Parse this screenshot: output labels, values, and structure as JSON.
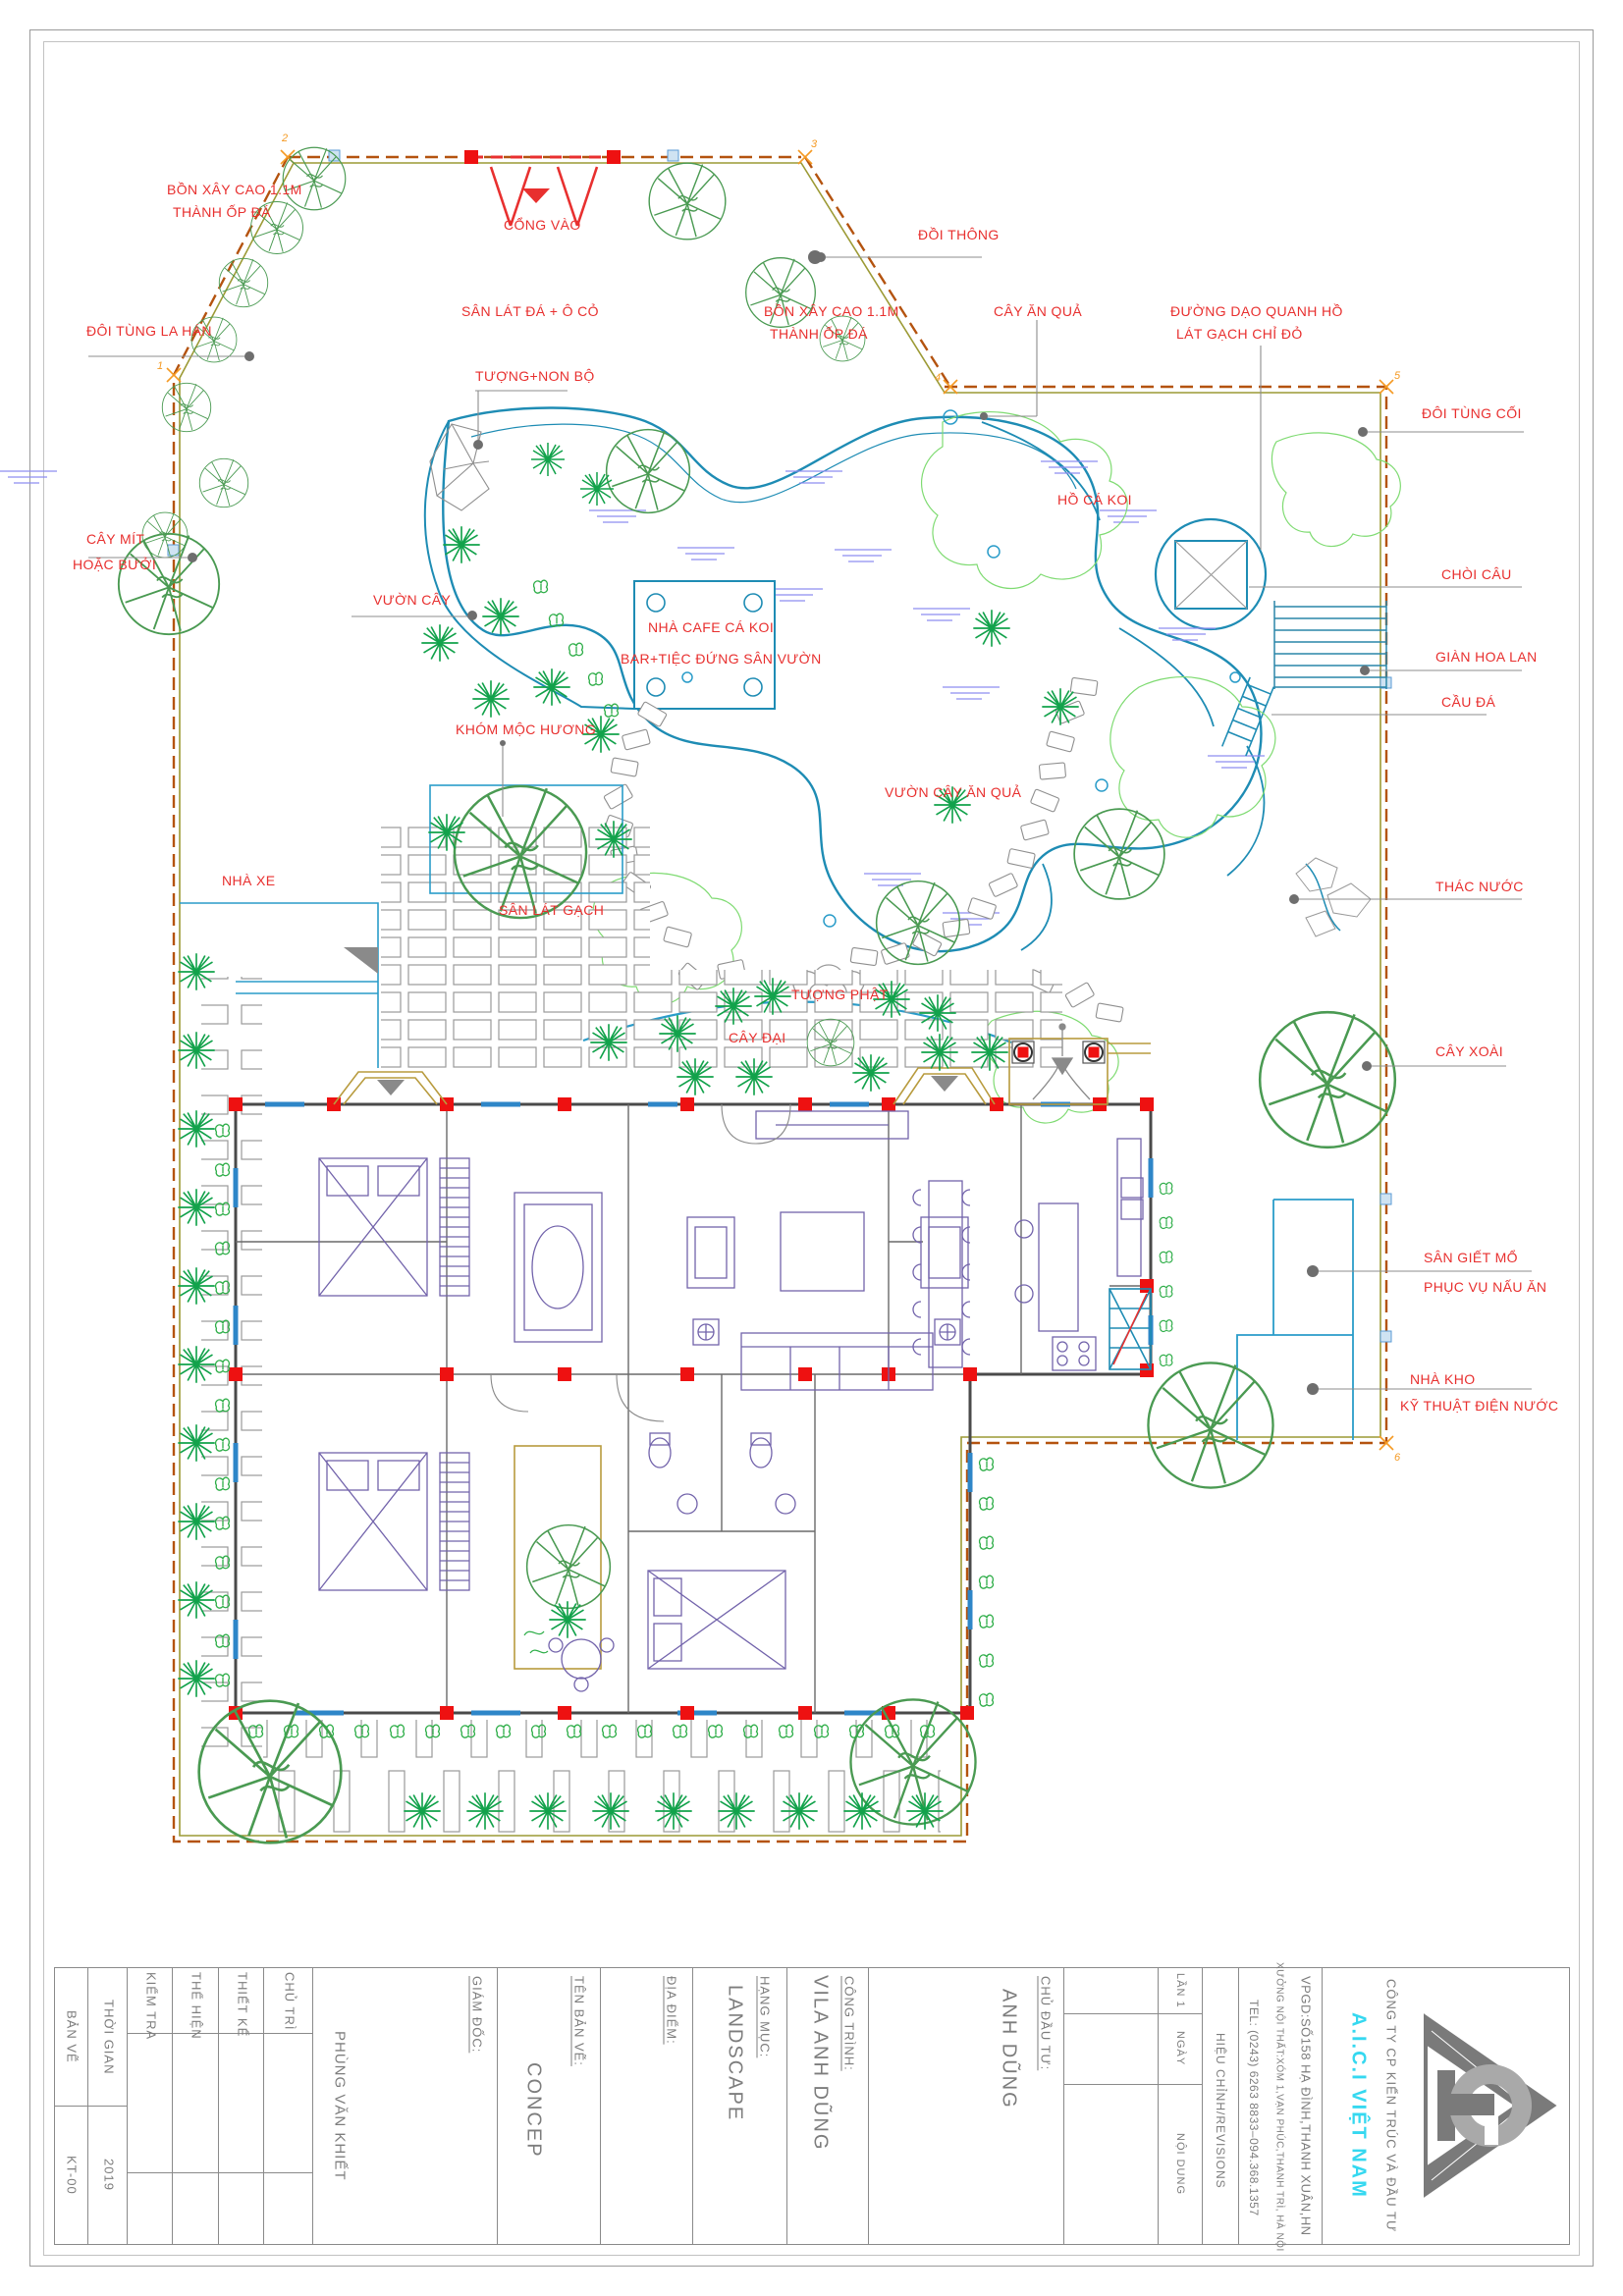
{
  "plan": {
    "labels": {
      "bon_xay_1a": "BỒN XÂY CAO 1.1M",
      "bon_xay_1b": "THÀNH ỐP ĐÁ",
      "cong_vao": "CỔNG VÀO",
      "doi_thong": "ĐỒI THÔNG",
      "doi_tung_la_han": "ĐÔI TÙNG LA HÁN",
      "san_lat_da": "SÂN LÁT ĐÁ  + Ô CỎ",
      "bon_xay_2a": "BỒN XÂY CAO 1.1M",
      "bon_xay_2b": "THÀNH ỐP ĐÁ",
      "cay_an_qua": "CÂY ĂN QUẢ",
      "duong_dao_a": "ĐƯỜNG DẠO QUANH HỒ",
      "duong_dao_b": "LÁT GẠCH CHỈ ĐỎ",
      "tuong_non_bo": "TƯỢNG+NON BỘ",
      "doi_tung_coi": "ĐÔI TÙNG CỐI",
      "ho_ca_koi": "HỒ CÁ KOI",
      "cay_mit_a": "CÂY MÍT",
      "cay_mit_b": "HOẶC BƯỞI",
      "choi_cau": "CHÒI CÂU",
      "vuon_cay": "VƯỜN CÂY",
      "nha_cafe_a": "NHÀ CAFE CÁ KOI",
      "nha_cafe_b": "BAR+TIỆC ĐỨNG SÂN VƯỜN",
      "gian_hoa_lan": "GIÀN HOA LAN",
      "cau_da": "CẦU ĐÁ",
      "khom_moc_huong": "KHÓM MỘC HƯƠNG",
      "vuon_cay_an_qua": "VƯỜN CÂY ĂN QUẢ",
      "nha_xe": "NHÀ XE",
      "san_lat_gach": "SÂN LÁT GẠCH",
      "thac_nuoc": "THÁC NƯỚC",
      "tuong_phat": "TƯỢNG PHẬT",
      "cay_dai": "CÂY ĐẠI",
      "cay_xoai": "CÂY XOÀI",
      "san_giet_mo_a": "SÂN GIẾT MỔ",
      "san_giet_mo_b": "PHỤC VỤ NẤU ĂN",
      "nha_kho_a": "NHÀ KHO",
      "nha_kho_b": "KỸ THUẬT ĐIỆN NƯỚC"
    },
    "corner_markers": {
      "m1": "1",
      "m2": "2",
      "m3": "3",
      "m4": "4",
      "m5": "5",
      "m6": "6"
    }
  },
  "title_block": {
    "ban_ve": "BẢN VẼ",
    "kt": "KT-00",
    "thoi_gian": "THỜI GIAN",
    "nam": "2019",
    "kiem_tra": "KIỂM TRA",
    "the_hien": "THỂ HIỆN",
    "thiet_ke": "THIẾT KẾ",
    "chu_tri": "CHỦ TRÌ",
    "nguoi": "PHÙNG VĂN KHIẾT",
    "giam_doc": "GIÁM ĐỐC:",
    "concep": "CONCEP",
    "ten_ban_ve": "TÊN BẢN VẼ:",
    "dia_diem": "ĐỊA ĐIỂM:",
    "landscape": "LANDSCAPE",
    "hang_muc": "HẠNG MỤC:",
    "vila": "VILA ANH DŨNG",
    "cong_trinh": "CÔNG TRÌNH:",
    "chu_dau_tu": "CHỦ ĐẦU TƯ:",
    "anh_dung": "ANH DŨNG",
    "lan": "LẦN 1",
    "ngay": "NGÀY",
    "noi_dung": "NỘI DUNG",
    "hieu_chinh": "HIỆU CHỈNH/REVISIONS",
    "tel": "TEL: (0243) 6263 8833–094.368.1357",
    "xuong": "XƯỞNG NỘI THẤT:XÓM 1,VẠN PHÚC,THANH TRÌ, HÀ NỘI",
    "vpgd": "VPGD:SỐ158 HẠ ĐÌNH,THANH XUÂN,HN",
    "cong_ty": "CÔNG TY CP KIẾN TRÚC VÀ ĐẦU TƯ",
    "brand": "A.I.C.I VIỆT NAM"
  },
  "colors": {
    "label_red": "#e8302f",
    "boundary_brown": "#b4530f",
    "boundary_olive": "#9c9a35",
    "water_teal": "#1e8cb4",
    "water_hatch": "#8d8df0",
    "tree_green": "#4a9a52",
    "palm_green": "#12a24b",
    "column_red": "#ee1111",
    "brand_cyan": "#35d8f0",
    "title_gray": "#7d7d7d"
  }
}
